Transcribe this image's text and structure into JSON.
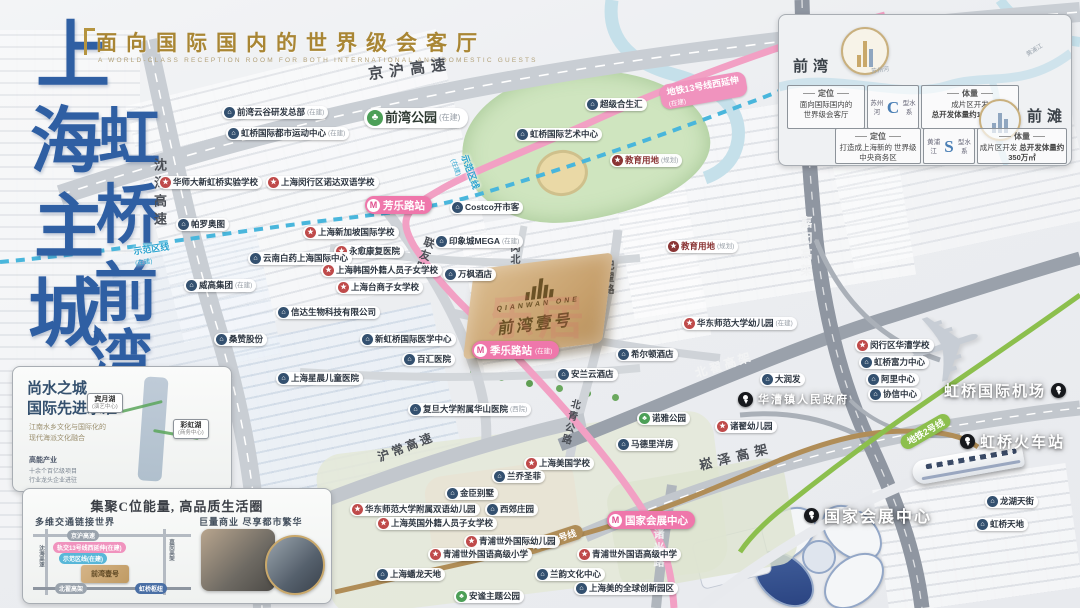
{
  "brand": {
    "headline": "面向国际国内的世界级会客厅",
    "headline_en": "A WORLD-CLASS RECEPTION ROOM FOR BOTH INTERNATIONAL AND DOMESTIC GUESTS",
    "chars": [
      {
        "c": "上",
        "x": 36,
        "y": 20,
        "s": 74
      },
      {
        "c": "海",
        "x": 30,
        "y": 106,
        "s": 72
      },
      {
        "c": "主",
        "x": 34,
        "y": 194,
        "s": 70
      },
      {
        "c": "城",
        "x": 28,
        "y": 278,
        "s": 74
      },
      {
        "c": "虹",
        "x": 98,
        "y": 108,
        "s": 62
      },
      {
        "c": "桥",
        "x": 96,
        "y": 184,
        "s": 64
      },
      {
        "c": "前",
        "x": 94,
        "y": 262,
        "s": 64
      },
      {
        "c": "湾",
        "x": 90,
        "y": 330,
        "s": 62
      }
    ]
  },
  "watermark": "乐居",
  "property": {
    "logo_en": "QIANWAN ONE",
    "logo_cn": "前湾壹号"
  },
  "park_label": {
    "t": "前湾公园",
    "s": "(在建)",
    "x": 364,
    "y": 108
  },
  "info_panel": {
    "qianwan": {
      "name": "前湾",
      "pos_head": "定位",
      "pos_line1": "面向国际国内的",
      "pos_line2": "世界级会客厅",
      "river": "苏州河",
      "river_shape": "C",
      "river_suffix": "型水系",
      "vol_head": "体量",
      "vol_line1": "成片区开发",
      "vol_line2": "总开发体量约1200万㎡"
    },
    "qiantan": {
      "name": "前滩",
      "pos_head": "定位",
      "pos_line1": "打造成上海新的",
      "pos_line2": "世界级中央商务区",
      "river": "黄浦江",
      "river_shape": "S",
      "river_suffix": "型水系",
      "vol_head": "体量",
      "vol_line1": "成片区开发",
      "vol_line2": "总开发体量约350万㎡"
    },
    "river_label1": "苏州河",
    "river_label2": "黄浦江"
  },
  "water_box": {
    "title1": "尚水之城",
    "title2": "国际先进水准",
    "sub1": "江南水乡文化与国际化的",
    "sub2": "现代海派文化融合",
    "lake1": "宾月湖",
    "lake1_s": "(演艺中心)",
    "lake2": "彩虹湖",
    "lake2_s": "(商务中心)",
    "foot_head": "高能产业",
    "foot1": "十余个百亿级项目",
    "foot2": "行业龙头企业进驻"
  },
  "c_box": {
    "title": "集聚C位能量, 高品质生活圈",
    "left_head": "多维交通链接世界",
    "right_head": "巨量商业 尽享都市繁华",
    "diagram": {
      "h1": "京沪高速",
      "pink": "轨交13号线西延伸(在建)",
      "blue": "示范区线(在建)",
      "v1": "沈海高速",
      "v2": "嘉闵高架",
      "h2": "北翟高架",
      "hub": "虹桥枢纽",
      "logo": "前湾壹号"
    }
  },
  "pois": [
    {
      "t": "前湾云谷研发总部",
      "s": "(在建)",
      "k": "biz",
      "x": 222,
      "y": 106
    },
    {
      "t": "虹桥国际都市运动中心",
      "s": "(在建)",
      "k": "biz",
      "x": 226,
      "y": 127
    },
    {
      "t": "华师大新虹桥实验学校",
      "s": "",
      "k": "school",
      "x": 158,
      "y": 176
    },
    {
      "t": "上海闵行区诺达双语学校",
      "s": "",
      "k": "school",
      "x": 266,
      "y": 176
    },
    {
      "t": "帕罗奥图",
      "s": "",
      "k": "biz",
      "x": 176,
      "y": 218
    },
    {
      "t": "上海新加坡国际学校",
      "s": "",
      "k": "school",
      "x": 303,
      "y": 226
    },
    {
      "t": "永愈康复医院",
      "s": "",
      "k": "school",
      "x": 334,
      "y": 245
    },
    {
      "t": "云南白药上海国际中心",
      "s": "",
      "k": "biz",
      "x": 248,
      "y": 252
    },
    {
      "t": "上海韩国外籍人员子女学校",
      "s": "",
      "k": "school",
      "x": 321,
      "y": 264
    },
    {
      "t": "上海台商子女学校",
      "s": "",
      "k": "school",
      "x": 336,
      "y": 281
    },
    {
      "t": "威高集团",
      "s": "(在建)",
      "k": "biz",
      "x": 184,
      "y": 279
    },
    {
      "t": "信达生物科技有限公司",
      "s": "",
      "k": "biz",
      "x": 276,
      "y": 306
    },
    {
      "t": "桑赞股份",
      "s": "",
      "k": "biz",
      "x": 214,
      "y": 333
    },
    {
      "t": "Costco开市客",
      "s": "",
      "k": "biz",
      "x": 450,
      "y": 201
    },
    {
      "t": "超级合生汇",
      "s": "",
      "k": "biz",
      "x": 585,
      "y": 98
    },
    {
      "t": "虹桥国际艺术中心",
      "s": "",
      "k": "biz",
      "x": 515,
      "y": 128
    },
    {
      "t": "教育用地",
      "s": "(规划)",
      "k": "edu",
      "x": 610,
      "y": 154
    },
    {
      "t": "教育用地",
      "s": "(规划)",
      "k": "edu",
      "x": 666,
      "y": 240
    },
    {
      "t": "印象城MEGA",
      "s": "(在建)",
      "k": "biz",
      "x": 434,
      "y": 235
    },
    {
      "t": "万枫酒店",
      "s": "",
      "k": "biz",
      "x": 443,
      "y": 268
    },
    {
      "t": "新虹桥国际医学中心",
      "s": "",
      "k": "biz",
      "x": 360,
      "y": 333
    },
    {
      "t": "百汇医院",
      "s": "",
      "k": "biz",
      "x": 402,
      "y": 353
    },
    {
      "t": "上海星晨儿童医院",
      "s": "",
      "k": "biz",
      "x": 276,
      "y": 372
    },
    {
      "t": "希尔顿酒店",
      "s": "",
      "k": "biz",
      "x": 616,
      "y": 348
    },
    {
      "t": "安兰云酒店",
      "s": "",
      "k": "biz",
      "x": 556,
      "y": 368
    },
    {
      "t": "复旦大学附属华山医院",
      "s": "(西院)",
      "k": "biz",
      "x": 408,
      "y": 403
    },
    {
      "t": "华东师范大学幼儿园",
      "s": "(在建)",
      "k": "school",
      "x": 682,
      "y": 317
    },
    {
      "t": "大润发",
      "s": "",
      "k": "biz",
      "x": 760,
      "y": 373
    },
    {
      "t": "诺雅公园",
      "s": "",
      "k": "park",
      "x": 637,
      "y": 412
    },
    {
      "t": "诸翟幼儿园",
      "s": "",
      "k": "school",
      "x": 715,
      "y": 420
    },
    {
      "t": "马德里洋房",
      "s": "",
      "k": "biz",
      "x": 616,
      "y": 438
    },
    {
      "t": "闵行区华漕学校",
      "s": "",
      "k": "school",
      "x": 855,
      "y": 339
    },
    {
      "t": "虹桥富力中心",
      "s": "",
      "k": "biz",
      "x": 859,
      "y": 356
    },
    {
      "t": "阿里中心",
      "s": "",
      "k": "biz",
      "x": 866,
      "y": 373
    },
    {
      "t": "协信中心",
      "s": "",
      "k": "biz",
      "x": 868,
      "y": 388
    },
    {
      "t": "龙湖天街",
      "s": "",
      "k": "biz",
      "x": 985,
      "y": 495
    },
    {
      "t": "虹桥天地",
      "s": "",
      "k": "biz",
      "x": 975,
      "y": 518
    },
    {
      "t": "上海美国学校",
      "s": "",
      "k": "school",
      "x": 524,
      "y": 457
    },
    {
      "t": "兰乔圣菲",
      "s": "",
      "k": "biz",
      "x": 492,
      "y": 470
    },
    {
      "t": "金臣别墅",
      "s": "",
      "k": "biz",
      "x": 445,
      "y": 487
    },
    {
      "t": "西郊庄园",
      "s": "",
      "k": "biz",
      "x": 485,
      "y": 503
    },
    {
      "t": "华东师范大学附属双语幼儿园",
      "s": "",
      "k": "school",
      "x": 350,
      "y": 503
    },
    {
      "t": "上海英国外籍人员子女学校",
      "s": "",
      "k": "school",
      "x": 376,
      "y": 517
    },
    {
      "t": "青浦世外国际幼儿园",
      "s": "",
      "k": "school",
      "x": 464,
      "y": 535
    },
    {
      "t": "青浦世外国语高级小学",
      "s": "",
      "k": "school",
      "x": 428,
      "y": 548
    },
    {
      "t": "青浦世外国语高级中学",
      "s": "",
      "k": "school",
      "x": 577,
      "y": 548
    },
    {
      "t": "上海蟠龙天地",
      "s": "",
      "k": "biz",
      "x": 375,
      "y": 568
    },
    {
      "t": "安谧主题公园",
      "s": "",
      "k": "park",
      "x": 454,
      "y": 590
    },
    {
      "t": "兰韵文化中心",
      "s": "",
      "k": "biz",
      "x": 535,
      "y": 568
    },
    {
      "t": "上海美的全球创新园区",
      "s": "",
      "k": "biz",
      "x": 574,
      "y": 582
    }
  ],
  "pins": [
    {
      "t": "虹桥国际机场",
      "x": 944,
      "y": 380,
      "side": "right",
      "size": 15
    },
    {
      "t": "虹桥火车站",
      "x": 960,
      "y": 431,
      "side": "left",
      "size": 15
    },
    {
      "t": "国家会展中心",
      "x": 804,
      "y": 503,
      "side": "left",
      "size": 16
    },
    {
      "t": "华漕镇人民政府",
      "x": 738,
      "y": 391,
      "side": "left",
      "size": 11
    }
  ],
  "stations": [
    {
      "t": "芳乐路站",
      "s": "",
      "x": 365,
      "y": 196
    },
    {
      "t": "季乐路站",
      "s": "(在建)",
      "x": 472,
      "y": 341
    },
    {
      "t": "国家会展中心",
      "s": "",
      "x": 607,
      "y": 511
    }
  ],
  "road_labels": [
    {
      "t": "京沪高速",
      "x": 368,
      "y": 58,
      "rot": -7,
      "size": 15,
      "ls": 6,
      "c": "#4a4e55"
    },
    {
      "t": "沈海高速",
      "x": 150,
      "y": 158,
      "vert": true,
      "size": 13,
      "ls": 5,
      "c": "#4a4e55"
    },
    {
      "t": "嘉闵高架",
      "x": 798,
      "y": 216,
      "vert": true,
      "size": 12,
      "ls": 4,
      "c": "#f2f3f4"
    },
    {
      "t": "北翟高架",
      "x": 694,
      "y": 356,
      "rot": -17,
      "size": 12,
      "ls": 3,
      "c": "#f2f3f4"
    },
    {
      "t": "崧泽高架",
      "x": 698,
      "y": 446,
      "rot": -14,
      "size": 13,
      "ls": 6,
      "c": "#4a4e55"
    },
    {
      "t": "沪常高速",
      "x": 376,
      "y": 438,
      "rot": -21,
      "size": 12,
      "ls": 3,
      "c": "#4a4e55"
    },
    {
      "t": "诸光路",
      "x": 650,
      "y": 528,
      "vert": true,
      "size": 11,
      "ls": 3,
      "c": "#f2f3f4"
    },
    {
      "t": "联友路",
      "x": 416,
      "y": 236,
      "vert": true,
      "rot": 18,
      "size": 11,
      "ls": 2,
      "c": "#4a4e55"
    },
    {
      "t": "纪翟路",
      "x": 600,
      "y": 260,
      "vert": true,
      "size": 10,
      "ls": 2,
      "c": "#4a4e55"
    },
    {
      "t": "闵北路",
      "x": 506,
      "y": 242,
      "vert": true,
      "size": 10,
      "ls": 2,
      "c": "#4a4e55"
    },
    {
      "t": "季乐路",
      "x": 560,
      "y": 326,
      "rot": 12,
      "size": 10,
      "ls": 2,
      "c": "#4a4e55"
    },
    {
      "t": "北青公路",
      "x": 562,
      "y": 398,
      "vert": true,
      "rot": 14,
      "size": 10,
      "ls": 2,
      "c": "#4a4e55"
    }
  ],
  "line_labels": [
    {
      "t": "地铁13号线西延伸",
      "s": "(在建)",
      "x": 660,
      "y": 78,
      "rot": -10,
      "k": "pink"
    },
    {
      "t": "示范区线",
      "s": "(在建)",
      "x": 134,
      "y": 242,
      "rot": -8,
      "k": "blue"
    },
    {
      "t": "示范区线",
      "s": "(在建)",
      "x": 448,
      "y": 162,
      "rot": 70,
      "k": "blue"
    },
    {
      "t": "地铁2号线",
      "s": "",
      "x": 898,
      "y": 424,
      "rot": -30,
      "k": "green"
    },
    {
      "t": "地铁17号线",
      "s": "",
      "x": 524,
      "y": 532,
      "rot": -18,
      "k": "brown"
    }
  ],
  "colors": {
    "metro_pink": "#f2a0c4",
    "demo_blue": "#49b6dc",
    "line2_green": "#8cbf4d",
    "line17_brown": "#b08d57",
    "gold": "#c9a86b"
  }
}
